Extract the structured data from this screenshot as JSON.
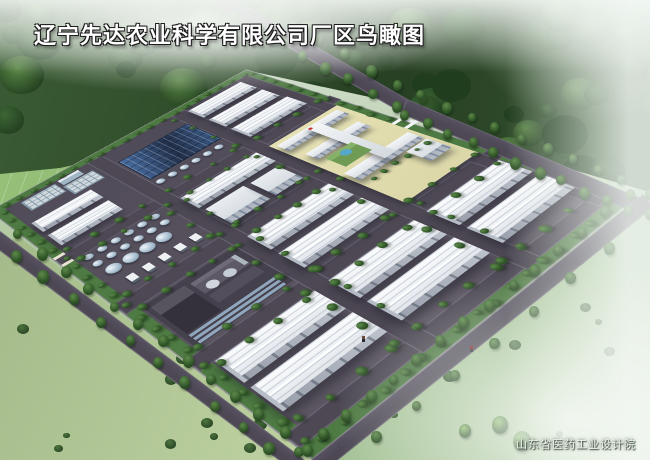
{
  "title": {
    "text": "辽宁先达农业科学有限公司厂区鸟瞰图"
  },
  "credit": {
    "text": "山东省医药工业设计院"
  },
  "palette": {
    "road": "#4d4854",
    "road_edge": "rgba(150,145,160,0.38)",
    "pavement_a": "#4e4956",
    "pavement_b": "#5d5763",
    "verge": "#4e7a43",
    "hedge": "#3c6838",
    "roof_top": "#fbfcfd",
    "roof_bot": "#dde2e8",
    "roof_line": "rgba(148,160,176,0.4)",
    "wall_a": "#9aa1ad",
    "wall_b": "#bcc2cb",
    "door": "rgba(80,88,102,0.55)",
    "endwall": "#b7bdc7",
    "ms_roof_a": "#e9edf1",
    "ms_roof_b": "#d2d8de",
    "ms_win": "rgba(93,112,137,0.6)",
    "ms_wall": "#aab1bc",
    "solar_a": "#496ea2",
    "solar_b": "#222f48",
    "pool_base": "#cfd8dc",
    "pool_line": "#849aa9",
    "tank_hi": "#eef5f9",
    "tank_mid": "#a9bfd0",
    "tank_lo": "#71869a",
    "court": "#dbd7a8",
    "bar_wall": "#b6bcc6",
    "forest_a": "#3a5c33",
    "forest_b": "#273f23",
    "blob_dark": "#203d1e",
    "blob_mid": "#3d6635",
    "blob_lite": "#5d8a48",
    "lawn_a": "#9cc47e",
    "lawn_b": "#7fae62",
    "field_bl_a": "#c3d6a6",
    "field_bl_b": "#9db483",
    "field_r_a": "#a8c499",
    "field_r_b": "#8fb184",
    "tree_hi": "#5d8a4a",
    "tree_mid": "#2f5427",
    "tree_dark": "#203d1e",
    "bush": "#47703a",
    "bright_tree": "#79b351",
    "truck": "#eef1f2",
    "figure_red": "#8a2020",
    "figure_dark": "#2a2a34"
  },
  "scene": {
    "regions": {
      "forest": "polygon(0px 0px, 650px 0px, 650px 192px, 560px 166px, 420px 108px, 246px 70px, 132px 152px, 60px 168px, 0px 174px)",
      "lawn": "polygon(0px 162px, 148px 140px, 246px 66px, 252px 82px, 2px 218px, 0px 218px)",
      "field_bl": "polygon(0px 242px, 20px 238px, 330px 472px, 0px 472px)",
      "field_right": "polygon(636px 188px, 650px 184px, 650px 460px, 318px 460px)"
    },
    "outside_roads": [
      {
        "x": 222,
        "y": -8,
        "len": 218,
        "w": 13,
        "ang": 30
      },
      {
        "x": 407,
        "y": 99,
        "len": 252,
        "w": 14,
        "ang": 23
      },
      {
        "x": 306,
        "y": 464,
        "len": 430,
        "w": 15,
        "ang": -38.7
      },
      {
        "x": -16,
        "y": 219,
        "len": 414,
        "w": 14,
        "ang": 36.9
      }
    ],
    "screen_tree_rows": [
      [
        212,
        2,
        396,
        106,
        9,
        8
      ],
      [
        240,
        -4,
        424,
        98,
        8,
        8
      ],
      [
        404,
        114,
        630,
        210,
        11,
        9
      ],
      [
        420,
        94,
        648,
        192,
        10,
        8
      ],
      [
        300,
        452,
        630,
        194,
        15,
        9
      ],
      [
        336,
        468,
        650,
        216,
        9,
        8
      ],
      [
        -6,
        216,
        308,
        450,
        14,
        9
      ],
      [
        -12,
        236,
        298,
        468,
        12,
        9
      ]
    ],
    "accent_trees": [
      [
        500,
        424,
        8
      ],
      [
        522,
        440,
        9
      ],
      [
        465,
        430,
        6
      ]
    ],
    "figures": [
      [
        470,
        346
      ],
      [
        362,
        336
      ]
    ],
    "scatters": [
      {
        "target": "forest",
        "kind": "canopy",
        "x": -10,
        "y": -12,
        "w": 670,
        "h": 205,
        "n": 95,
        "rmin": 8,
        "rmax": 24
      },
      {
        "target": "field-bl",
        "kind": "bush",
        "x": 6,
        "y": 296,
        "w": 300,
        "h": 162,
        "n": 18,
        "rmin": 3,
        "rmax": 7
      },
      {
        "target": "field-right",
        "kind": "bush",
        "x": 348,
        "y": 224,
        "w": 290,
        "h": 228,
        "n": 13,
        "rmin": 3,
        "rmax": 7
      }
    ],
    "campus": {
      "w": 300,
      "h": 420,
      "matrix": [
        0.975429,
        -0.435115,
        0.00049835,
        0.478627,
        0.166057,
        -0.00092148,
        -11,
        211
      ],
      "items": [
        {
          "t": "verge",
          "u": 0,
          "v": 0,
          "w": 300,
          "h": 10
        },
        {
          "t": "verge",
          "u": 0,
          "v": 0,
          "w": 10,
          "h": 420
        },
        {
          "t": "verge",
          "u": 0,
          "v": 410,
          "w": 300,
          "h": 10
        },
        {
          "t": "verge",
          "u": 290,
          "v": 0,
          "w": 10,
          "h": 420
        },
        {
          "t": "road",
          "u": 0,
          "v": 120,
          "w": 300,
          "h": 14
        },
        {
          "t": "road",
          "u": 0,
          "v": 210,
          "w": 212,
          "h": 16
        },
        {
          "t": "road",
          "u": 0,
          "v": 300,
          "w": 300,
          "h": 14
        },
        {
          "t": "road",
          "u": 0,
          "v": 396,
          "w": 300,
          "h": 12
        },
        {
          "t": "road",
          "u": 98,
          "v": 10,
          "w": 14,
          "h": 400
        },
        {
          "t": "road",
          "u": 196,
          "v": 10,
          "w": 14,
          "h": 400
        },
        {
          "t": "road",
          "u": 278,
          "v": 10,
          "w": 12,
          "h": 130
        },
        {
          "t": "road",
          "u": 278,
          "v": 296,
          "w": 12,
          "h": 110
        },
        {
          "t": "pool",
          "u": 24,
          "v": 14,
          "w": 34,
          "h": 20
        },
        {
          "t": "pool",
          "u": 62,
          "v": 26,
          "w": 30,
          "h": 20
        },
        {
          "t": "box",
          "u": 64,
          "v": 12,
          "w": 22,
          "h": 12,
          "c": "#9fb6c6",
          "c2": "#e6edf2"
        },
        {
          "t": "wh",
          "u": 14,
          "v": 54,
          "w": 58,
          "h": 22
        },
        {
          "t": "wh",
          "u": 14,
          "v": 84,
          "w": 58,
          "h": 24
        },
        {
          "t": "solar",
          "u": 116,
          "v": 36,
          "w": 78,
          "h": 52
        },
        {
          "t": "tankrow",
          "u": 120,
          "v": 100,
          "n": 6,
          "s": 13,
          "r": 4
        },
        {
          "t": "wh",
          "u": 212,
          "v": 16,
          "w": 64,
          "h": 26
        },
        {
          "t": "wh",
          "u": 212,
          "v": 50,
          "w": 64,
          "h": 26
        },
        {
          "t": "wh",
          "u": 212,
          "v": 84,
          "w": 66,
          "h": 28
        },
        {
          "t": "tankrow",
          "u": 20,
          "v": 142,
          "n": 6,
          "s": 13,
          "r": 4
        },
        {
          "t": "tankrow",
          "u": 20,
          "v": 156,
          "n": 6,
          "s": 13,
          "r": 4
        },
        {
          "t": "tankrow",
          "u": 24,
          "v": 172,
          "n": 4,
          "s": 16,
          "r": 6.5
        },
        {
          "t": "truckrow",
          "u": 24,
          "v": 190,
          "n": 5,
          "s": 15
        },
        {
          "t": "wh",
          "u": 114,
          "v": 138,
          "w": 80,
          "h": 26
        },
        {
          "t": "ms",
          "u": 116,
          "v": 170,
          "w": 40,
          "h": 34
        },
        {
          "t": "ms",
          "u": 162,
          "v": 172,
          "w": 30,
          "h": 32
        },
        {
          "t": "court",
          "u": 210,
          "v": 140,
          "w": 82,
          "h": 156
        },
        {
          "t": "bar",
          "u": 214,
          "v": 146,
          "w": 72,
          "h": 16
        },
        {
          "t": "bar",
          "u": 218,
          "v": 178,
          "w": 62,
          "h": 16
        },
        {
          "t": "bar",
          "u": 214,
          "v": 228,
          "w": 74,
          "h": 18
        },
        {
          "t": "bar",
          "u": 248,
          "v": 146,
          "w": 13,
          "h": 100
        },
        {
          "t": "ms",
          "u": 264,
          "v": 248,
          "w": 24,
          "h": 26
        },
        {
          "t": "box",
          "u": 222,
          "v": 198,
          "w": 30,
          "h": 24,
          "c": "#6f9b55",
          "c2": "#86b168"
        },
        {
          "t": "circ",
          "u": 238,
          "v": 206,
          "r": 5,
          "c": "#55a7c9"
        },
        {
          "t": "circ",
          "u": 250,
          "v": 150,
          "r": 2,
          "c": "#c83232"
        },
        {
          "t": "box",
          "u": 292,
          "v": 206,
          "w": 18,
          "h": 3.5,
          "c": "#f5f7f8"
        },
        {
          "t": "box",
          "u": 292,
          "v": 220,
          "w": 18,
          "h": 3.5,
          "c": "#f5f7f8"
        },
        {
          "t": "box",
          "u": 301,
          "v": 206,
          "w": 4,
          "h": 18,
          "c": "#eef1f3"
        },
        {
          "t": "box",
          "u": 12,
          "v": 230,
          "w": 86,
          "h": 66,
          "c": "#44404c"
        },
        {
          "t": "box",
          "u": 16,
          "v": 236,
          "w": 30,
          "h": 44,
          "c": "#34313d",
          "c2": "#58545f"
        },
        {
          "t": "box",
          "u": 50,
          "v": 238,
          "w": 42,
          "h": 18,
          "c": "#5d5966",
          "c2": "#6e6a78"
        },
        {
          "t": "box",
          "u": 50,
          "v": 260,
          "w": 42,
          "h": 12,
          "c": "#524e5c"
        },
        {
          "t": "box",
          "u": 16,
          "v": 282,
          "w": 76,
          "h": 2.5,
          "c": "#8fa6bd"
        },
        {
          "t": "box",
          "u": 16,
          "v": 287,
          "w": 76,
          "h": 2.5,
          "c": "#8fa6bd"
        },
        {
          "t": "box",
          "u": 16,
          "v": 292,
          "w": 76,
          "h": 2.5,
          "c": "#8fa6bd"
        },
        {
          "t": "circ",
          "u": 60,
          "v": 252,
          "r": 5,
          "c": "#cfd7dc"
        },
        {
          "t": "circ",
          "u": 76,
          "v": 252,
          "r": 5,
          "c": "#c4cdd3"
        },
        {
          "t": "box",
          "u": 88,
          "v": 238,
          "w": 4,
          "h": 16,
          "c": "#aeb6bd"
        },
        {
          "t": "wh",
          "u": 112,
          "v": 228,
          "w": 82,
          "h": 28
        },
        {
          "t": "wh",
          "u": 112,
          "v": 264,
          "w": 82,
          "h": 28
        },
        {
          "t": "wh",
          "u": 12,
          "v": 316,
          "w": 84,
          "h": 30
        },
        {
          "t": "wh",
          "u": 12,
          "v": 352,
          "w": 84,
          "h": 30
        },
        {
          "t": "wh",
          "u": 112,
          "v": 316,
          "w": 82,
          "h": 30
        },
        {
          "t": "wh",
          "u": 112,
          "v": 352,
          "w": 82,
          "h": 30
        },
        {
          "t": "wh",
          "u": 210,
          "v": 316,
          "w": 78,
          "h": 30
        },
        {
          "t": "wh",
          "u": 210,
          "v": 352,
          "w": 78,
          "h": 30
        },
        {
          "t": "box",
          "u": 0,
          "v": 118,
          "w": 10,
          "h": 4,
          "c": "#e8e4d4"
        },
        {
          "t": "box",
          "u": 0,
          "v": 132,
          "w": 10,
          "h": 4,
          "c": "#e8e4d4"
        }
      ],
      "tree_rows": [
        [
          12,
          6,
          290,
          6,
          20,
          5
        ],
        [
          6,
          14,
          6,
          406,
          22,
          5
        ],
        [
          14,
          414,
          290,
          414,
          18,
          5
        ],
        [
          296,
          12,
          296,
          198,
          11,
          5
        ],
        [
          14,
          117,
          288,
          117,
          12,
          5
        ],
        [
          14,
          137,
          188,
          137,
          9,
          5
        ],
        [
          14,
          207,
          206,
          207,
          10,
          5
        ],
        [
          14,
          229,
          206,
          229,
          10,
          5
        ],
        [
          14,
          297,
          288,
          297,
          12,
          5
        ],
        [
          14,
          319,
          288,
          319,
          12,
          5
        ],
        [
          14,
          393,
          288,
          393,
          12,
          5
        ],
        [
          95,
          150,
          95,
          392,
          10,
          5
        ],
        [
          115,
          146,
          115,
          392,
          9,
          5
        ],
        [
          193,
          18,
          193,
          392,
          13,
          5
        ],
        [
          215,
          306,
          215,
          392,
          4,
          5
        ],
        [
          222,
          252,
          284,
          252,
          6,
          4
        ]
      ]
    }
  }
}
